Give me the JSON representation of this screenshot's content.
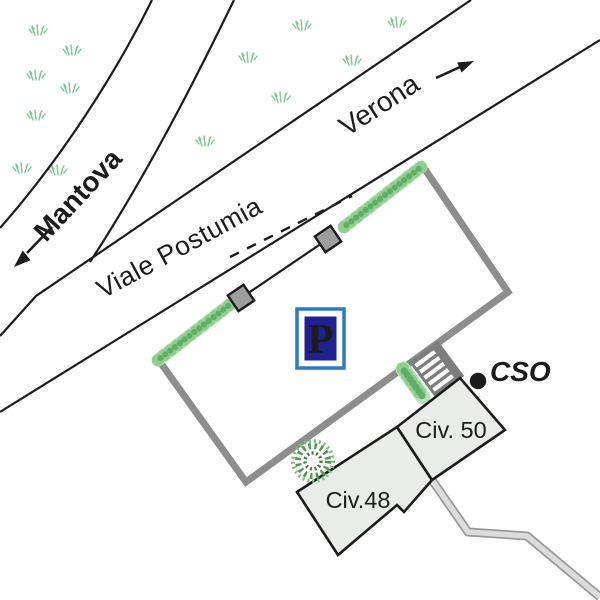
{
  "title": "Parking location sketch map",
  "streets": {
    "main": "Viale Postumia",
    "direction_west": "Mantova",
    "direction_east": "Verona"
  },
  "buildings": {
    "b48": "Civ.48",
    "b50": "Civ. 50"
  },
  "markers": {
    "cso": "CSO",
    "parking_symbol": "P"
  },
  "colors": {
    "road_line": "#1c1c1c",
    "wall_gray": "#8d8d8d",
    "gate_fill": "#9e9e9e",
    "building_fill": "#eaece9",
    "building_stroke": "#1c1c1c",
    "hedge_base": "#b9e2b6",
    "hedge_dot_light": "#8ecf90",
    "hedge_dot_dark": "#5fae66",
    "grass": "#7fc497",
    "tree_dark": "#529752",
    "tree_mid": "#7fbf7f",
    "tree_inner": "#447f44",
    "stairs_gray": "#7d7d7d",
    "walkway_fill": "#dcdcdc",
    "walkway_edge": "#9a9a9a",
    "dot_black": "#1a1a1a",
    "p_frame_blue": "#2b7cc3",
    "p_navy": "#20208e",
    "p_letter_color": "#ffffff"
  }
}
